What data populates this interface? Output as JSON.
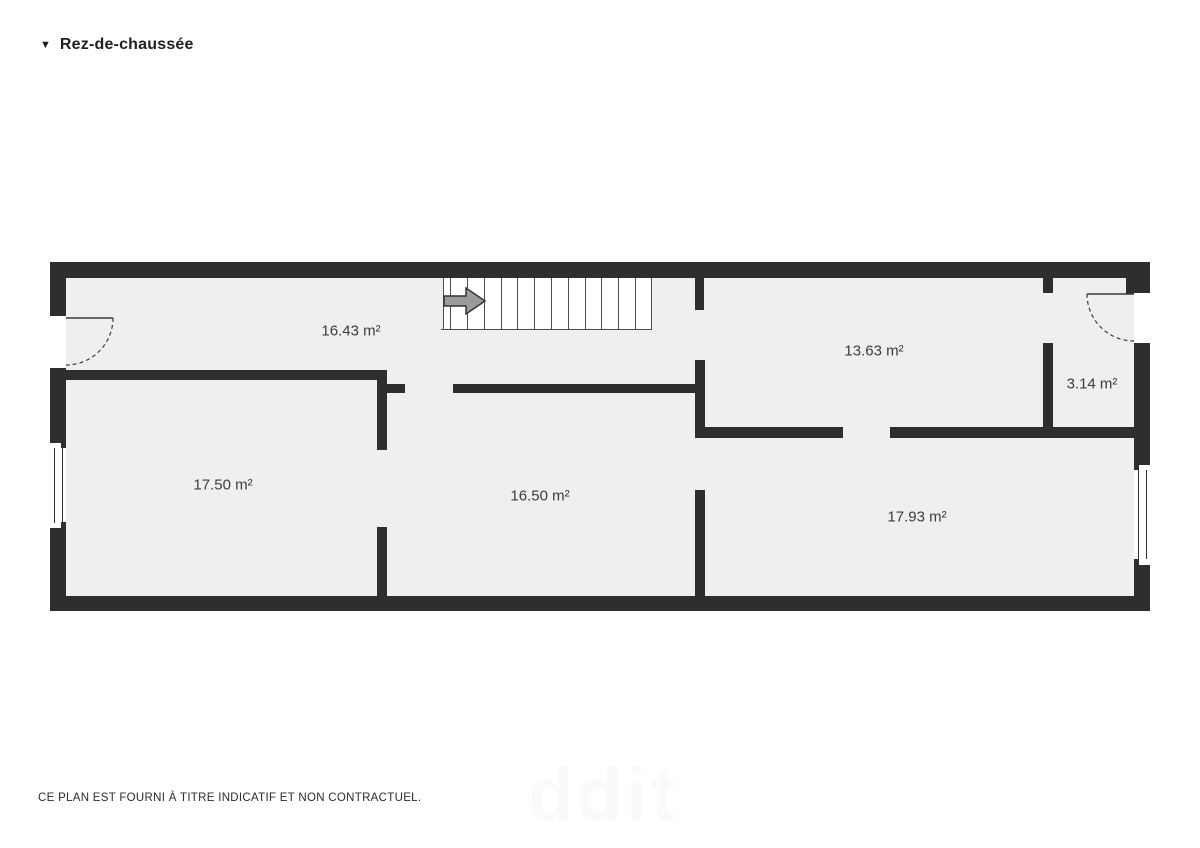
{
  "header": {
    "marker": "▼",
    "title": "Rez-de-chaussée"
  },
  "footer": {
    "disclaimer": "CE PLAN EST FOURNI À TITRE INDICATIF ET NON CONTRACTUEL."
  },
  "watermark": {
    "text": "ddit"
  },
  "colors": {
    "page": "#ffffff",
    "wall": "#2e2e2e",
    "floor": "#efefef",
    "label": "#3c3c3c",
    "stair_line": "#4d4d4d",
    "arrow_fill": "#9b9b9b",
    "arrow_stroke": "#333333",
    "door_line": "#3a3a3a"
  },
  "plan": {
    "floor": {
      "x": 50,
      "y": 262,
      "w": 1100,
      "h": 349
    },
    "walls": [
      {
        "x": 50,
        "y": 262,
        "w": 1100,
        "h": 16
      },
      {
        "x": 50,
        "y": 596,
        "w": 1100,
        "h": 15
      },
      {
        "x": 50,
        "y": 262,
        "w": 16,
        "h": 54
      },
      {
        "x": 50,
        "y": 368,
        "w": 16,
        "h": 75
      },
      {
        "x": 50,
        "y": 528,
        "w": 16,
        "h": 83
      },
      {
        "x": 1134,
        "y": 262,
        "w": 16,
        "h": 31
      },
      {
        "x": 1134,
        "y": 343,
        "w": 16,
        "h": 122
      },
      {
        "x": 1134,
        "y": 565,
        "w": 16,
        "h": 46
      },
      {
        "x": 1126,
        "y": 278,
        "w": 24,
        "h": 16
      },
      {
        "x": 66,
        "y": 370,
        "w": 321,
        "h": 10
      },
      {
        "x": 377,
        "y": 370,
        "w": 10,
        "h": 80
      },
      {
        "x": 377,
        "y": 527,
        "w": 10,
        "h": 69
      },
      {
        "x": 387,
        "y": 384,
        "w": 18,
        "h": 9
      },
      {
        "x": 453,
        "y": 384,
        "w": 244,
        "h": 9
      },
      {
        "x": 695,
        "y": 278,
        "w": 9,
        "h": 32
      },
      {
        "x": 695,
        "y": 360,
        "w": 10,
        "h": 78
      },
      {
        "x": 695,
        "y": 490,
        "w": 10,
        "h": 106
      },
      {
        "x": 703,
        "y": 427,
        "w": 140,
        "h": 11
      },
      {
        "x": 890,
        "y": 427,
        "w": 244,
        "h": 11
      },
      {
        "x": 1043,
        "y": 278,
        "w": 10,
        "h": 15
      },
      {
        "x": 1043,
        "y": 343,
        "w": 10,
        "h": 85
      }
    ],
    "door_openings": [
      {
        "x": 50,
        "y": 316,
        "w": 16,
        "h": 52
      },
      {
        "x": 1134,
        "y": 293,
        "w": 16,
        "h": 50
      }
    ],
    "windows": [
      {
        "x": 50,
        "y": 443,
        "w": 16,
        "h": 85,
        "panes": [
          {
            "x": 54,
            "y1": 448,
            "y2": 523
          },
          {
            "x": 62,
            "y1": 448,
            "y2": 523
          }
        ]
      },
      {
        "x": 1134,
        "y": 465,
        "w": 16,
        "h": 100,
        "panes": [
          {
            "x": 1138,
            "y1": 470,
            "y2": 559
          },
          {
            "x": 1146,
            "y1": 470,
            "y2": 559
          }
        ]
      }
    ],
    "window_notches": [
      {
        "x": 61,
        "y": 441,
        "w": 5,
        "h": 7
      },
      {
        "x": 61,
        "y": 522,
        "w": 5,
        "h": 7
      },
      {
        "x": 1134,
        "y": 463,
        "w": 5,
        "h": 7
      },
      {
        "x": 1134,
        "y": 559,
        "w": 5,
        "h": 7
      }
    ],
    "doors": [
      {
        "leaf": [
          66,
          318,
          113,
          318
        ],
        "arc": {
          "from": [
            113,
            318
          ],
          "to": [
            66,
            365
          ],
          "r": 47,
          "sweep": 1
        }
      },
      {
        "leaf": [
          1134,
          294,
          1087,
          294
        ],
        "arc": {
          "from": [
            1087,
            294
          ],
          "to": [
            1134,
            341
          ],
          "r": 47,
          "sweep": 0
        }
      }
    ],
    "stairs": {
      "x": 443,
      "y": 278,
      "w": 209,
      "h": 51,
      "steps": [
        450,
        467,
        484,
        501,
        517,
        534,
        551,
        568,
        585,
        601,
        618,
        635
      ],
      "arrow_points": "444,296 466,296 466,288 485,301 466,314 466,306 444,306"
    },
    "rooms": [
      {
        "id": "hallway",
        "label": "16.43 m²",
        "cx": 351,
        "cy": 331
      },
      {
        "id": "room-1363",
        "label": "13.63 m²",
        "cx": 874,
        "cy": 351
      },
      {
        "id": "entry-sas",
        "label": "3.14 m²",
        "cx": 1092,
        "cy": 384
      },
      {
        "id": "room-1750",
        "label": "17.50 m²",
        "cx": 223,
        "cy": 485
      },
      {
        "id": "room-1650",
        "label": "16.50 m²",
        "cx": 540,
        "cy": 496
      },
      {
        "id": "room-1793",
        "label": "17.93 m²",
        "cx": 917,
        "cy": 517
      }
    ]
  }
}
